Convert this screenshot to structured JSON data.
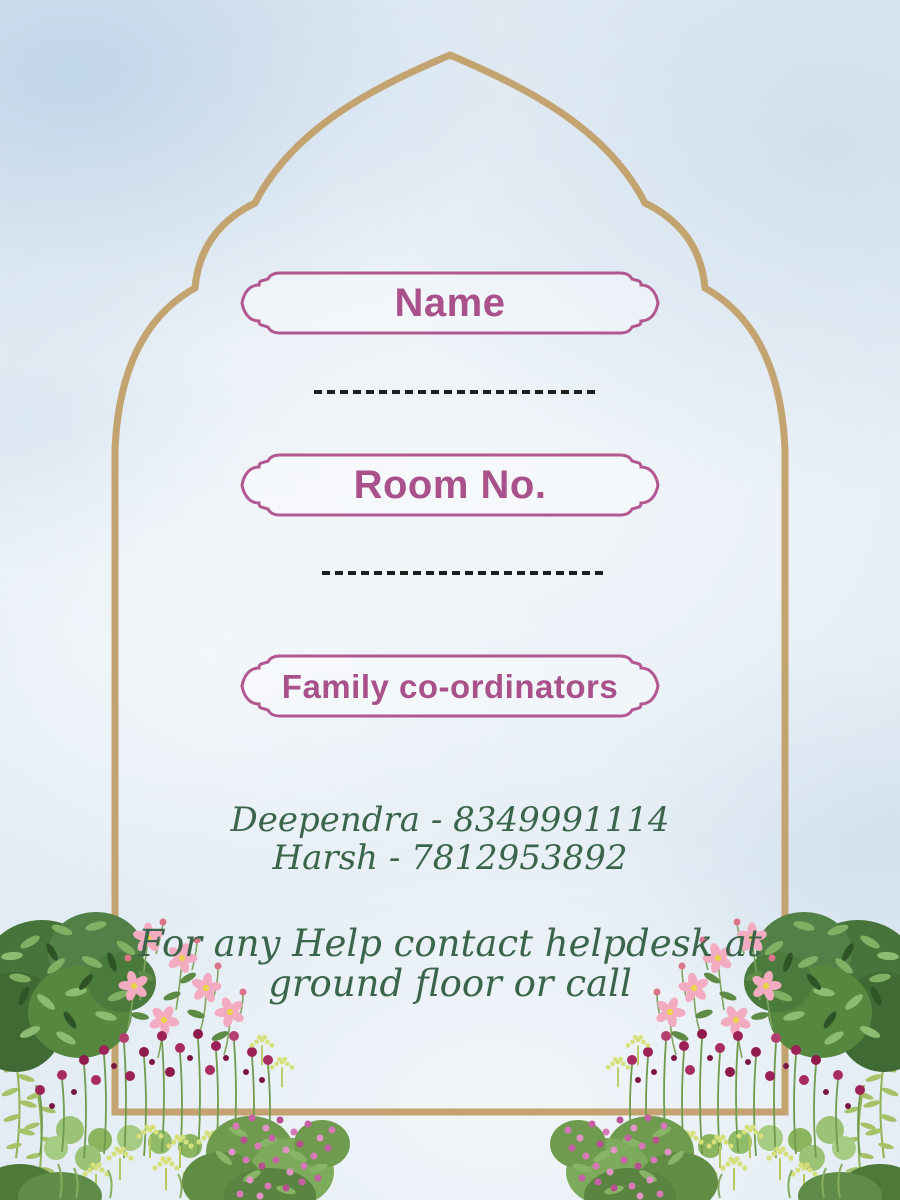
{
  "card": {
    "type": "room-allotment-card",
    "fields": {
      "name_label": "Name",
      "room_label": "Room No.",
      "family_label": "Family co-ordinators"
    },
    "coordinators": [
      "Deependra - 8349991114",
      "Harsh - 7812953892"
    ],
    "help": {
      "line1": "For any Help contact helpdesk at",
      "line2": "ground floor or call"
    },
    "colors": {
      "background": "#e3ecf4",
      "arch_gold": "#c3a36f",
      "plaque_border": "#b2578f",
      "plaque_text": "#a9518a",
      "green_text": "#3a654a",
      "dash_line": "#1e1e1e"
    },
    "decor": {
      "arch": "mughal-arch-border",
      "plaque": "ornamental-label-frame",
      "left_floral": "watercolor-flower-bush",
      "right_floral": "watercolor-flower-bush-mirrored"
    }
  }
}
